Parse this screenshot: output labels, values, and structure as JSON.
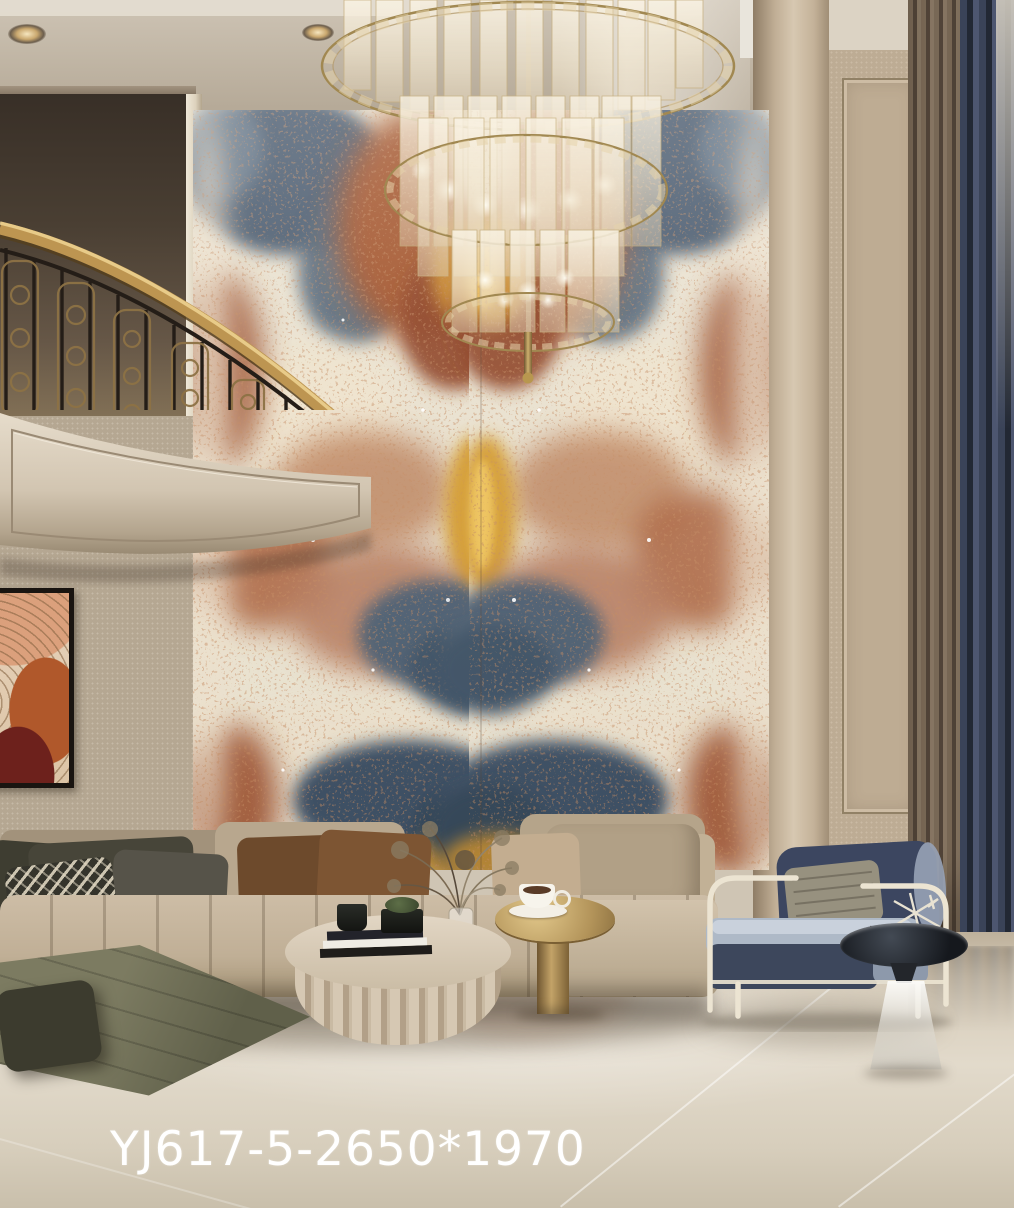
{
  "caption": {
    "text": "YJ617-5-2650*1970"
  },
  "scene": {
    "description": "Luxury double-height living room showcasing a bookmatched blue-rust onyx marble feature wall, product code shown on floor",
    "objects": [
      "tiered crystal chandelier",
      "bookmatched onyx marble feature wall",
      "curved balcony with gold handrail and iron balusters",
      "framed abstract wall art",
      "beige channel-tufted sectional sofa with pillows",
      "olive green chaise bench",
      "fluted round coffee table with books and vessels",
      "gold pedestal side table with coffee cup",
      "navy and cream armchair with knit pillow",
      "glass cone side table",
      "beige pilaster columns",
      "floor-to-ceiling curtains",
      "polished beige marble floor",
      "recessed ceiling spotlights",
      "dried flower arrangement in glass vase"
    ]
  },
  "palette": {
    "marble_rust": "#a0522d",
    "marble_blue": "#46586c",
    "marble_gold": "#d29b33",
    "marble_cream": "#e9e1cf",
    "wall_beige": "#c4b29a",
    "wall_dark_upper": "#4a3f33",
    "railing_gold": "#bd9551",
    "baluster_iron": "#241d17",
    "sofa_tan": "#c5b49b",
    "chaise_green": "#72715a",
    "armchair_navy": "#3d4862",
    "armchair_frame": "#ece4d2",
    "curtain_navy": "#39425a",
    "curtain_taupe": "#7d6c59",
    "floor_beige": "#d6cbb8",
    "caption_color": "#ffffff"
  }
}
